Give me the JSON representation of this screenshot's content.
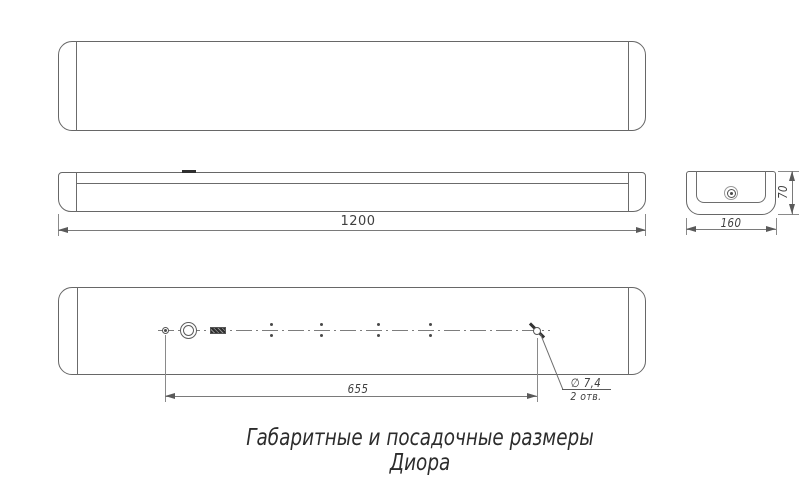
{
  "drawing": {
    "labels": {
      "length": "1200",
      "width": "160",
      "height": "70",
      "hole_spacing": "655",
      "hole_diameter": "∅ 7,4",
      "hole_quantity": "2 отв."
    },
    "caption": {
      "line1": "Габаритные и посадочные размеры",
      "line2": "Диора"
    },
    "colors": {
      "background": "#ffffff",
      "outline": "#676767",
      "dimension_line": "#7a7a7a",
      "text": "#3f3f3f",
      "feature_dark": "#2f2f2f"
    }
  }
}
